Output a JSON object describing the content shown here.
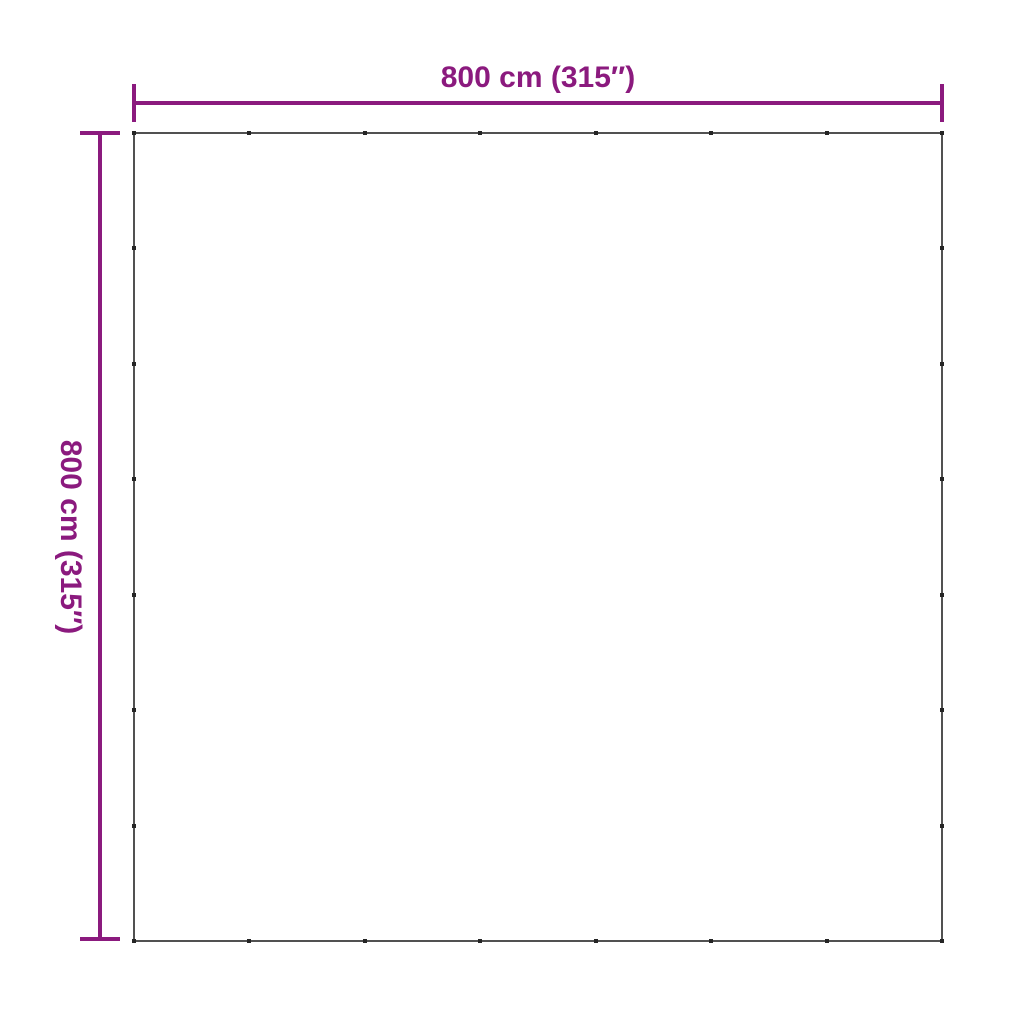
{
  "image": {
    "type": "product-dimension-diagram",
    "background": "#ffffff"
  },
  "colors": {
    "accent": "#8b1a7e",
    "outline": "#515151",
    "eyelet": "#252525"
  },
  "dimensions": {
    "width": {
      "label": "800 cm (315″)"
    },
    "height": {
      "label": "800 cm (315″)"
    }
  },
  "square": {
    "eyelets_per_side": 8
  }
}
